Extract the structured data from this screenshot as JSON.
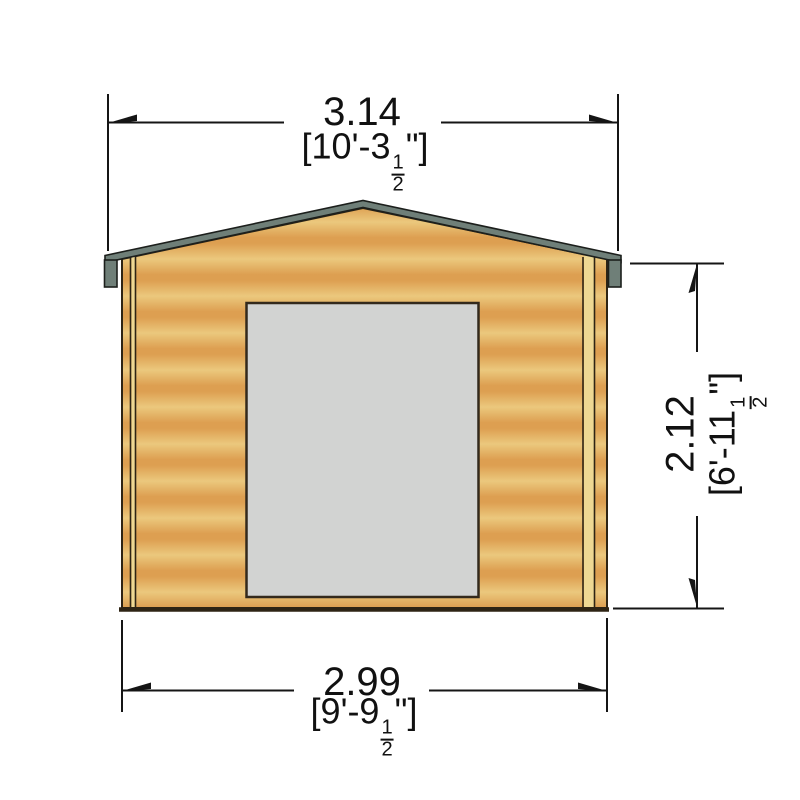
{
  "page": {
    "background": "#ffffff",
    "description": "Front elevation dimension drawing of a timber log cabin with central door opening, gabled roof and three dimension callouts"
  },
  "drawing": {
    "labels": {
      "roof_width": {
        "metric": "3.14",
        "imp_prefix": "[10'-3",
        "frac_num": "1",
        "frac_den": "2",
        "imp_suffix": "\"]"
      },
      "wall_width": {
        "metric": "2.99",
        "imp_prefix": "[9'-9",
        "frac_num": "1",
        "frac_den": "2",
        "imp_suffix": "\"]"
      },
      "wall_height": {
        "metric": "2.12",
        "imp_prefix": "[6'-11",
        "frac_num": "1",
        "frac_den": "2",
        "imp_suffix": "\"]"
      }
    },
    "colors": {
      "wood_light": "#ebc87d",
      "wood_dark": "#dd9f51",
      "trim_light": "#eed893",
      "fascia": "#6f7f78",
      "door": "#d2d3d2",
      "door_border": "#33291c",
      "outline": "#2e2414",
      "line": "#151515"
    }
  }
}
